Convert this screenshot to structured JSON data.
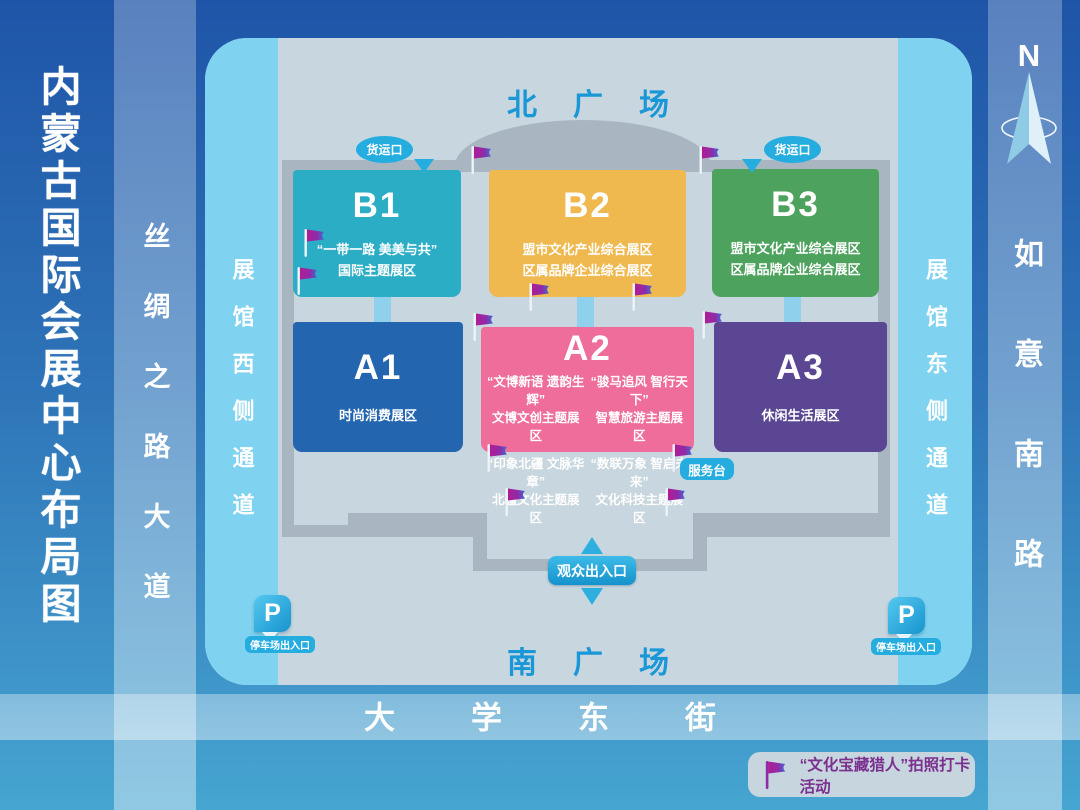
{
  "page": {
    "title": "内蒙古国际会展中心布局图"
  },
  "roads": {
    "west_vertical": "丝绸之路大道",
    "east_vertical": "如意南路",
    "south_horizontal": "大学东街"
  },
  "compass": {
    "letter": "N"
  },
  "map": {
    "north_plaza": "北广场",
    "south_plaza": "南广场",
    "west_passage": "展馆西侧通道",
    "east_passage": "展馆东侧通道",
    "freight_gate_left": "货运口",
    "freight_gate_right": "货运口",
    "service_desk": "服务台",
    "visitor_gate": "观众出入口",
    "parking_badge": "P",
    "parking_left": "停车场出入口",
    "parking_right": "停车场出入口"
  },
  "halls": [
    {
      "code": "B1",
      "lines": [
        "“一带一路 美美与共”",
        "国际主题展区"
      ],
      "color": "#2BADC6"
    },
    {
      "code": "B2",
      "lines": [
        "盟市文化产业综合展区",
        "区属品牌企业综合展区"
      ],
      "color": "#F0B950"
    },
    {
      "code": "B3",
      "lines": [
        "盟市文化产业综合展区",
        "区属品牌企业综合展区"
      ],
      "color": "#4DA25D"
    },
    {
      "code": "A1",
      "lines": [
        "时尚消费展区"
      ],
      "color": "#2365AE"
    },
    {
      "code": "A2",
      "color": "#EE6D9A",
      "cells": [
        {
          "quote": "“文博新语 遗韵生辉”",
          "name": "文博文创主题展区"
        },
        {
          "quote": "“骏马追风 智行天下”",
          "name": "智慧旅游主题展区"
        },
        {
          "quote": "“印象北疆 文脉华章”",
          "name": "北疆文化主题展区"
        },
        {
          "quote": "“数联万象 智启未来”",
          "name": "文化科技主题展区"
        }
      ]
    },
    {
      "code": "A3",
      "lines": [
        "休闲生活展区"
      ],
      "color": "#5A4692"
    }
  ],
  "legend": {
    "label": "“文化宝藏猎人”拍照打卡活动"
  },
  "flags": [
    {
      "x": 470,
      "y": 145
    },
    {
      "x": 698,
      "y": 145
    },
    {
      "x": 303,
      "y": 228
    },
    {
      "x": 296,
      "y": 266
    },
    {
      "x": 472,
      "y": 312
    },
    {
      "x": 528,
      "y": 282
    },
    {
      "x": 631,
      "y": 282
    },
    {
      "x": 701,
      "y": 310
    },
    {
      "x": 486,
      "y": 443
    },
    {
      "x": 671,
      "y": 443
    },
    {
      "x": 504,
      "y": 487
    },
    {
      "x": 664,
      "y": 487
    }
  ],
  "colors": {
    "bg_top": "#1F55A8",
    "bg_bottom": "#46A5D1",
    "map_bg": "#C7D6DF",
    "passage_strip": "#7FD2F0",
    "wall": "#A9B6C1",
    "badge_cyan": "#26ADE0",
    "plaza_text": "#1A97D7",
    "legend_text": "#7B2F8E",
    "flag_magenta": "#B01C96",
    "flag_blue": "#3F6AD6"
  }
}
